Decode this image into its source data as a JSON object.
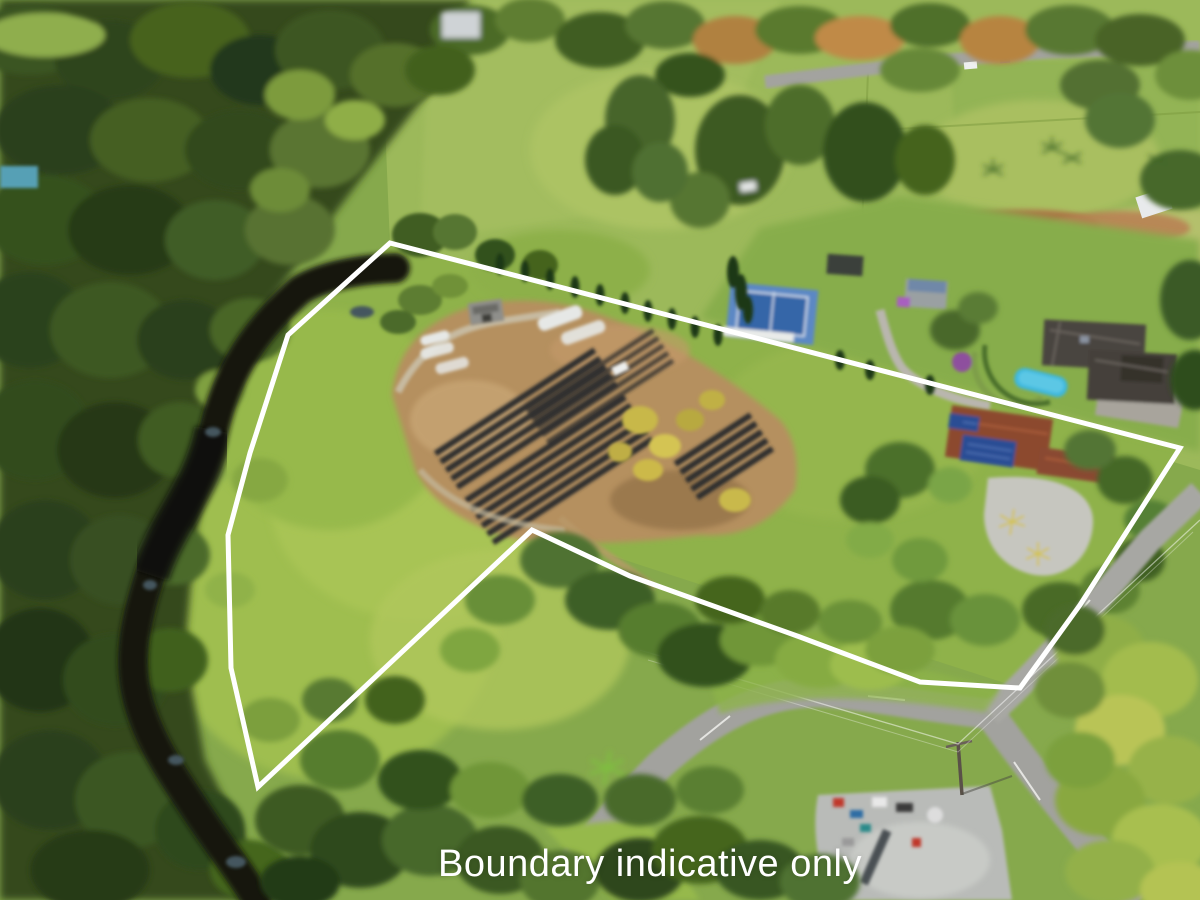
{
  "caption": {
    "text": "Boundary indicative only",
    "color": "#ffffff"
  },
  "boundary": {
    "stroke": "#ffffff",
    "stroke_width": 5,
    "points": "390,243 1180,448 1080,605 1020,688 920,682 800,637 630,576 532,530 258,787 231,668 228,535 250,453 288,335"
  },
  "palette": {
    "forest": "#36491f",
    "pasture": "#9cb95a",
    "property_grass": "#8fb24a",
    "creek": "#14180f",
    "nursery_soil": "#b5905f",
    "nursery_rows": "#2d2d2f",
    "tennis_court_outer": "#5b88c4",
    "tennis_court_inner": "#3566a8",
    "pool": "#3db8de",
    "neighbor_roof": "#4a453f",
    "subject_roof": "#8c4a2e",
    "solar_panels": "#2a4d94",
    "road": "#a2a29e",
    "gravel": "#c6c6bf",
    "greenhouse_white": "#e6e8e6"
  }
}
